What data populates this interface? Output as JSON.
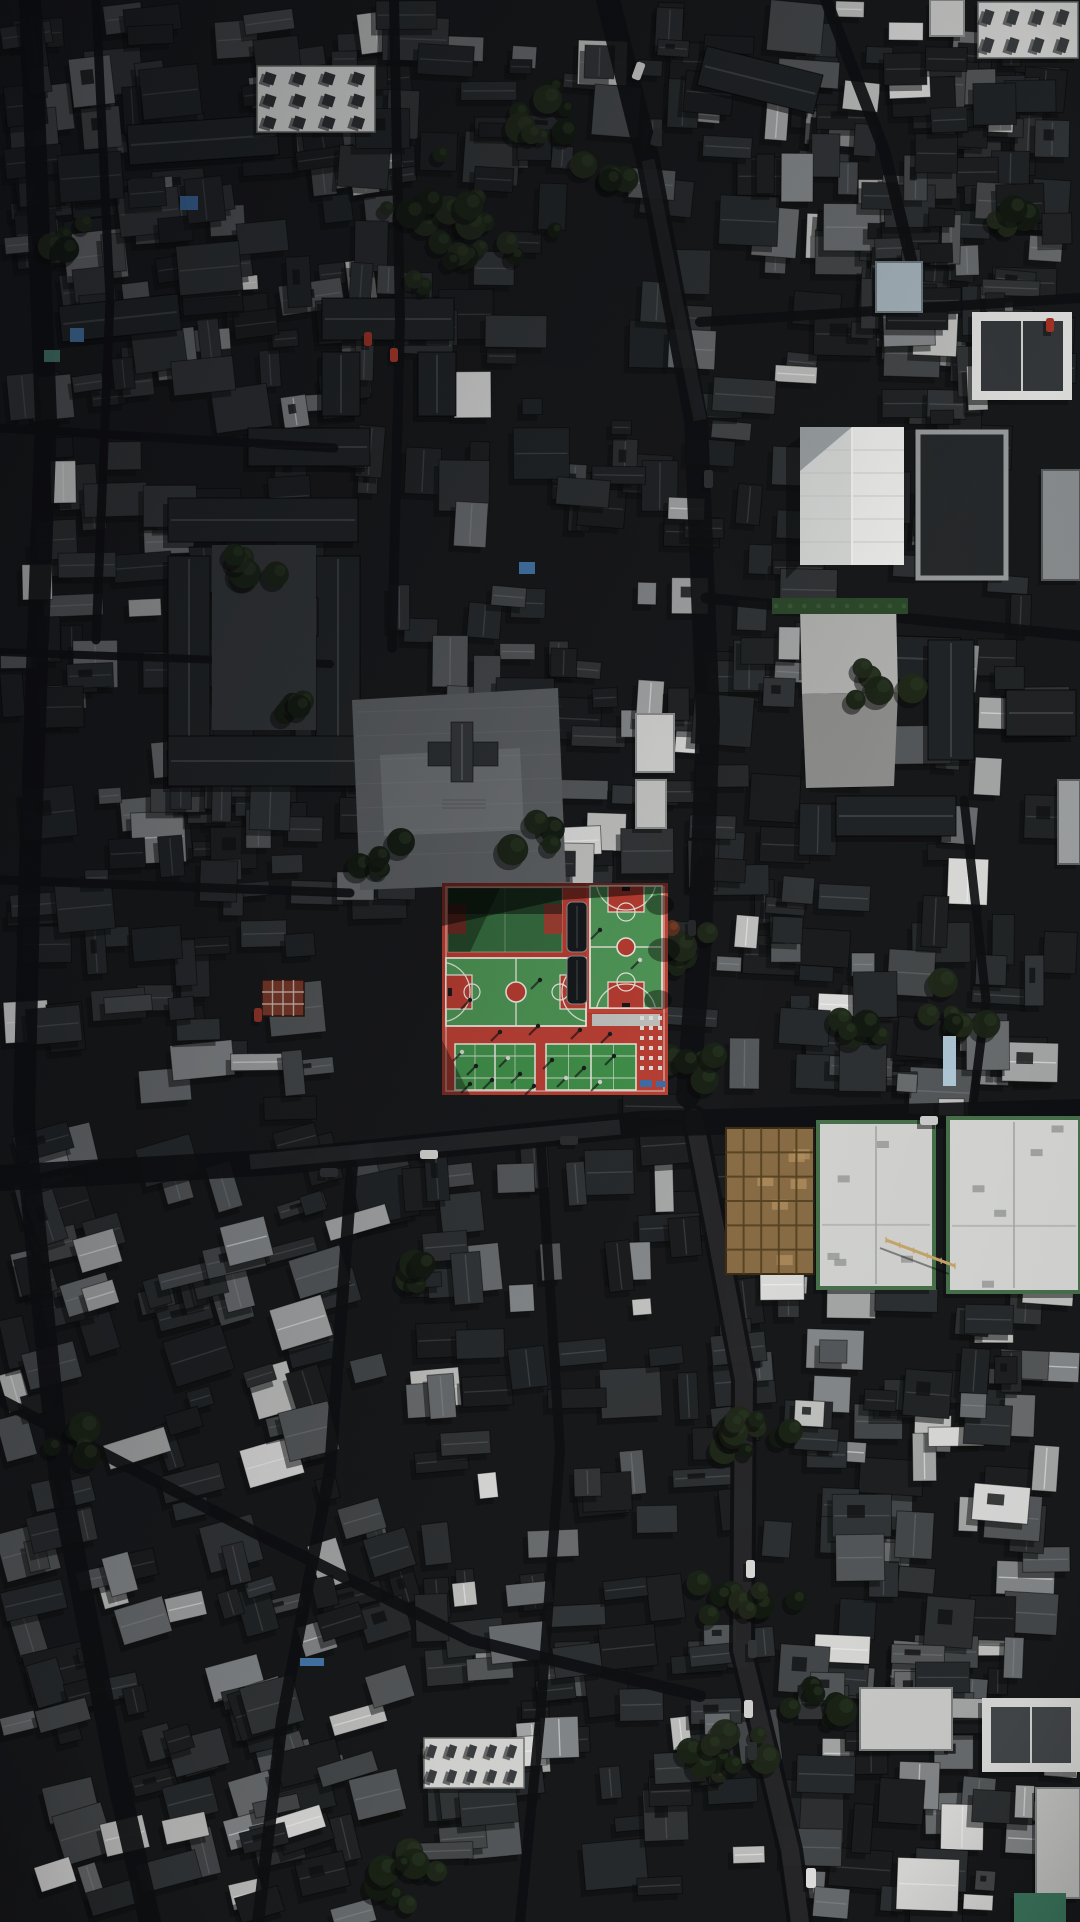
{
  "scene": {
    "type": "aerial-drone-photograph",
    "description": "Top-down aerial photo of a dense dark-roofed old city district; a bright red and green school sports complex (basketball and badminton courts) sits at the center, surrounded by charcoal tiled rooftops, narrow shadowed streets, tree clusters, a white gabled hall, large white flat roofs, and a tan construction site.",
    "canvas": {
      "width": 1080,
      "height": 1922
    },
    "seed": 1337,
    "palette": {
      "base": "#17181a",
      "street": "#0e0f11",
      "street_lit": "#3a3b3d",
      "roof_dark": [
        "#1d1f21",
        "#212426",
        "#272a2c",
        "#2d3032",
        "#323537",
        "#1a1c1e"
      ],
      "roof_mid": [
        "#45484a",
        "#55585a",
        "#6a6d6f"
      ],
      "roof_light": [
        "#86898b",
        "#a7a9a9",
        "#c3c4c2",
        "#dededd"
      ],
      "tree": [
        "#131a11",
        "#1a2316",
        "#20291a"
      ],
      "court_red": "#b93c30",
      "court_red_bright": "#c7463a",
      "court_green": "#4d9554",
      "court_green_shaded": "#356b3d",
      "court_line": "#efeee4",
      "construction_tan": "#8a6d46",
      "hedge_green": "#2d4a2b",
      "tarp_blue": "#3f6fa8"
    },
    "sun": {
      "from": "upper-right",
      "shadow_dx": -5,
      "shadow_dy": 6
    }
  },
  "districts": [
    {
      "x": 0,
      "y": 0,
      "w": 420,
      "h": 430,
      "n": 120,
      "light": 0.1,
      "mid": 0.18,
      "angle": -6
    },
    {
      "x": 330,
      "y": 0,
      "w": 350,
      "h": 700,
      "n": 70,
      "light": 0.06,
      "mid": 0.12,
      "angle": 2
    },
    {
      "x": 620,
      "y": 0,
      "w": 460,
      "h": 640,
      "n": 130,
      "light": 0.1,
      "mid": 0.16,
      "angle": 3
    },
    {
      "x": 860,
      "y": 0,
      "w": 220,
      "h": 430,
      "n": 60,
      "light": 0.12,
      "mid": 0.2,
      "angle": 0
    },
    {
      "x": 0,
      "y": 420,
      "w": 340,
      "h": 700,
      "n": 90,
      "light": 0.08,
      "mid": 0.15,
      "angle": -3
    },
    {
      "x": 150,
      "y": 700,
      "w": 300,
      "h": 220,
      "n": 40,
      "light": 0.06,
      "mid": 0.1,
      "angle": 0
    },
    {
      "x": 440,
      "y": 640,
      "w": 230,
      "h": 260,
      "n": 30,
      "light": 0.12,
      "mid": 0.2,
      "angle": 0
    },
    {
      "x": 620,
      "y": 620,
      "w": 460,
      "h": 500,
      "n": 110,
      "light": 0.1,
      "mid": 0.16,
      "angle": 2
    },
    {
      "x": 0,
      "y": 1120,
      "w": 420,
      "h": 810,
      "n": 150,
      "light": 0.16,
      "mid": 0.22,
      "angle": -15
    },
    {
      "x": 400,
      "y": 1120,
      "w": 380,
      "h": 800,
      "n": 110,
      "light": 0.12,
      "mid": 0.2,
      "angle": -4
    },
    {
      "x": 760,
      "y": 1260,
      "w": 320,
      "h": 670,
      "n": 120,
      "light": 0.3,
      "mid": 0.25,
      "angle": 2
    }
  ],
  "courtyard_roofs": [
    [
      168,
      498,
      190,
      44,
      0
    ],
    [
      168,
      556,
      42,
      226,
      0
    ],
    [
      316,
      556,
      44,
      226,
      0
    ],
    [
      168,
      736,
      234,
      50,
      0
    ],
    [
      226,
      598,
      92,
      38,
      0
    ],
    [
      322,
      298,
      132,
      42,
      0
    ],
    [
      322,
      352,
      38,
      64,
      0
    ],
    [
      418,
      352,
      38,
      64,
      0
    ],
    [
      248,
      428,
      122,
      38,
      0
    ],
    [
      128,
      120,
      150,
      40,
      -4
    ],
    [
      60,
      300,
      120,
      36,
      -6
    ],
    [
      840,
      636,
      120,
      44,
      2
    ],
    [
      928,
      640,
      46,
      120,
      0
    ],
    [
      1006,
      690,
      70,
      46,
      0
    ],
    [
      836,
      796,
      120,
      40,
      0
    ],
    [
      700,
      60,
      120,
      40,
      14
    ]
  ],
  "streets": [
    {
      "pts": [
        [
          30,
          0
        ],
        [
          46,
          420
        ],
        [
          30,
          860
        ],
        [
          24,
          1120
        ],
        [
          60,
          1480
        ],
        [
          120,
          1790
        ],
        [
          150,
          1922
        ]
      ],
      "w": 22
    },
    {
      "pts": [
        [
          96,
          0
        ],
        [
          110,
          300
        ],
        [
          96,
          640
        ]
      ],
      "w": 9
    },
    {
      "pts": [
        [
          394,
          0
        ],
        [
          400,
          320
        ],
        [
          392,
          648
        ]
      ],
      "w": 10
    },
    {
      "pts": [
        [
          608,
          0
        ],
        [
          648,
          160
        ],
        [
          696,
          420
        ],
        [
          708,
          720
        ],
        [
          700,
          940
        ],
        [
          688,
          1096
        ]
      ],
      "w": 24
    },
    {
      "pts": [
        [
          694,
          1118
        ],
        [
          744,
          1380
        ],
        [
          742,
          1650
        ],
        [
          790,
          1850
        ],
        [
          800,
          1922
        ]
      ],
      "w": 26,
      "lit": true
    },
    {
      "pts": [
        [
          0,
          1178
        ],
        [
          280,
          1162
        ],
        [
          640,
          1124
        ],
        [
          1080,
          1112
        ]
      ],
      "w": 26
    },
    {
      "pts": [
        [
          700,
          322
        ],
        [
          1080,
          298
        ]
      ],
      "w": 10
    },
    {
      "pts": [
        [
          706,
          598
        ],
        [
          1080,
          636
        ]
      ],
      "w": 11
    },
    {
      "pts": [
        [
          0,
          880
        ],
        [
          350,
          893
        ]
      ],
      "w": 9
    },
    {
      "pts": [
        [
          0,
          428
        ],
        [
          334,
          448
        ]
      ],
      "w": 9
    },
    {
      "pts": [
        [
          0,
          652
        ],
        [
          330,
          664
        ]
      ],
      "w": 8
    },
    {
      "pts": [
        [
          0,
          1400
        ],
        [
          250,
          1530
        ],
        [
          470,
          1640
        ],
        [
          700,
          1696
        ]
      ],
      "w": 12
    },
    {
      "pts": [
        [
          352,
          1165
        ],
        [
          330,
          1470
        ],
        [
          282,
          1720
        ],
        [
          258,
          1922
        ]
      ],
      "w": 12
    },
    {
      "pts": [
        [
          540,
          1130
        ],
        [
          560,
          1450
        ],
        [
          540,
          1720
        ],
        [
          520,
          1922
        ]
      ],
      "w": 10
    },
    {
      "pts": [
        [
          826,
          0
        ],
        [
          884,
          150
        ],
        [
          914,
          272
        ]
      ],
      "w": 12
    },
    {
      "pts": [
        [
          964,
          800
        ],
        [
          986,
          1000
        ],
        [
          972,
          1112
        ]
      ],
      "w": 9
    }
  ],
  "plazas": [
    {
      "name": "temple-plaza",
      "points": "352,700 558,688 566,882 360,890",
      "fill": "#5d6062"
    },
    {
      "name": "temple-plaza-light",
      "points": "380,755 520,748 524,830 384,836",
      "fill": "#6e7173"
    },
    {
      "name": "school-courtyard-ground",
      "points": "212,545 316,545 316,730 212,730",
      "fill": "#333638"
    },
    {
      "name": "east-lot-upper",
      "points": "800,607 896,602 898,692 802,694",
      "fill": "#b3b4b2"
    },
    {
      "name": "east-lot-lower",
      "points": "802,694 898,692 894,786 806,788",
      "fill": "#8e8f8d"
    }
  ],
  "pagoda": {
    "cx": 462,
    "cy": 750,
    "fill": "#34373a",
    "steps": {
      "x": 442,
      "y": 796,
      "w": 44,
      "h": 16,
      "fill": "#6e7173"
    }
  },
  "landmarks": [
    {
      "name": "solar-roof-courtyard",
      "type": "panelroof",
      "x": 257,
      "y": 66,
      "w": 118,
      "h": 66,
      "fill": "#e8e9e7",
      "panel": "#2f3234",
      "rows": 3,
      "cols": 4
    },
    {
      "name": "white-gable-hall",
      "type": "gable",
      "x": 800,
      "y": 427,
      "w": 104,
      "h": 138,
      "face1": "#dcdedc",
      "face2": "#f2f2f0",
      "shadow": "#9aa0a2",
      "seams": 5
    },
    {
      "name": "bordered-dark-building",
      "type": "flat",
      "x": 918,
      "y": 432,
      "w": 88,
      "h": 146,
      "fill": "#26292b",
      "stroke": "#9a9d9e",
      "sw": 5
    },
    {
      "name": "hedge-strip",
      "type": "hedge",
      "x": 772,
      "y": 598,
      "w": 136,
      "h": 16,
      "fill": "#2d4a2b"
    },
    {
      "name": "slate-blue-roof",
      "type": "flat",
      "x": 876,
      "y": 262,
      "w": 46,
      "h": 50,
      "fill": "#a9b6bf",
      "stroke": "#6d7a83",
      "sw": 2
    },
    {
      "name": "top-right-white-block",
      "type": "panelroof",
      "x": 978,
      "y": 2,
      "w": 100,
      "h": 56,
      "fill": "#d8d9d7",
      "panel": "#3a3d3f",
      "rows": 2,
      "cols": 4
    },
    {
      "name": "top-right-small-white",
      "type": "flat",
      "x": 930,
      "y": 0,
      "w": 34,
      "h": 36,
      "fill": "#cfd0ce",
      "stroke": "#8f9291",
      "sw": 2
    },
    {
      "name": "white-framed-gable",
      "type": "framedgable",
      "x": 972,
      "y": 312,
      "w": 100,
      "h": 88,
      "frame": "#e4e5e3",
      "inner": "#35383b"
    },
    {
      "name": "construction-site",
      "type": "construction",
      "x": 726,
      "y": 1128,
      "w": 88,
      "h": 146,
      "fill": "#8a6d46",
      "beam": "#54411f",
      "patch": "#b2905f"
    },
    {
      "name": "big-white-roof-west",
      "type": "bigwhite",
      "x": 818,
      "y": 1122,
      "w": 116,
      "h": 166,
      "fill": "#d6d7d4",
      "trim": "#47714b"
    },
    {
      "name": "big-white-roof-east",
      "type": "bigwhite",
      "x": 948,
      "y": 1118,
      "w": 132,
      "h": 174,
      "fill": "#dadbd8",
      "trim": "#47714b"
    },
    {
      "name": "right-edge-lit-facade",
      "type": "flat",
      "x": 1042,
      "y": 470,
      "w": 38,
      "h": 110,
      "fill": "#8b8e90",
      "stroke": "#55585a",
      "sw": 2
    },
    {
      "name": "right-edge-lit-facade-2",
      "type": "flat",
      "x": 1058,
      "y": 780,
      "w": 22,
      "h": 84,
      "fill": "#9fa2a3",
      "stroke": "#5f6264",
      "sw": 2
    },
    {
      "name": "lower-right-white-a",
      "type": "flat",
      "x": 860,
      "y": 1688,
      "w": 92,
      "h": 62,
      "fill": "#cfd0cd",
      "stroke": "#7e8182",
      "sw": 2
    },
    {
      "name": "lower-right-white-b",
      "type": "framedgable",
      "x": 982,
      "y": 1698,
      "w": 98,
      "h": 74,
      "frame": "#dddedc",
      "inner": "#44474a"
    },
    {
      "name": "lower-right-white-c",
      "type": "flat",
      "x": 1036,
      "y": 1788,
      "w": 44,
      "h": 110,
      "fill": "#c9cac8",
      "stroke": "#8a8d8c",
      "sw": 2
    },
    {
      "name": "teal-tarp",
      "type": "flat",
      "x": 1014,
      "y": 1893,
      "w": 52,
      "h": 29,
      "fill": "#3d7a60"
    },
    {
      "name": "red-lattice-roof",
      "type": "grid",
      "x": 262,
      "y": 980,
      "w": 42,
      "h": 36,
      "fill": "#7e3a2a",
      "line": "#d8d0c2"
    },
    {
      "name": "white-strip-building",
      "type": "panelroof",
      "x": 424,
      "y": 1738,
      "w": 100,
      "h": 50,
      "fill": "#d9dad8",
      "panel": "#3b3e40",
      "rows": 2,
      "cols": 5
    },
    {
      "name": "east-white-annex",
      "type": "flat",
      "x": 636,
      "y": 714,
      "w": 38,
      "h": 58,
      "fill": "#d7d8d6",
      "stroke": "#8e918f",
      "sw": 2
    },
    {
      "name": "east-white-annex-2",
      "type": "flat",
      "x": 636,
      "y": 780,
      "w": 30,
      "h": 48,
      "fill": "#c9cac8",
      "stroke": "#8e918f",
      "sw": 2
    }
  ],
  "sports_complex": {
    "base": {
      "x": 442,
      "y": 883,
      "w": 226,
      "h": 212
    },
    "left_upper_court": {
      "x": 448,
      "y": 888,
      "w": 114,
      "h": 64
    },
    "left_main_court": {
      "x": 446,
      "y": 958,
      "w": 140,
      "h": 68
    },
    "right_court": {
      "x": 590,
      "y": 886,
      "w": 72,
      "h": 122
    },
    "canopies": [
      [
        567,
        902,
        20,
        50
      ],
      [
        567,
        956,
        20,
        48
      ]
    ],
    "badminton_courts": [
      [
        455,
        1044,
        80,
        46
      ],
      [
        546,
        1044,
        90,
        46
      ]
    ],
    "equipment_area": {
      "x": 637,
      "y": 1012,
      "w": 30,
      "h": 64
    },
    "bench_strip": {
      "x": 592,
      "y": 1014,
      "w": 68,
      "h": 12,
      "fill": "#c4c5c1"
    },
    "tarp_items": [
      [
        640,
        1080,
        12,
        7
      ],
      [
        656,
        1081,
        10,
        6
      ]
    ],
    "people": [
      [
        462,
        1052
      ],
      [
        476,
        1066
      ],
      [
        492,
        1080
      ],
      [
        470,
        1084
      ],
      [
        508,
        1058
      ],
      [
        520,
        1074
      ],
      [
        534,
        1086
      ],
      [
        552,
        1060
      ],
      [
        566,
        1078
      ],
      [
        584,
        1068
      ],
      [
        600,
        1082
      ],
      [
        614,
        1056
      ],
      [
        500,
        1032
      ],
      [
        538,
        1026
      ],
      [
        580,
        1030
      ],
      [
        610,
        1034
      ],
      [
        470,
        1000
      ],
      [
        540,
        980
      ],
      [
        600,
        930
      ],
      [
        640,
        960
      ]
    ]
  },
  "tree_clusters": [
    [
      468,
      225,
      24,
      95
    ],
    [
      540,
      110,
      8,
      46
    ],
    [
      610,
      180,
      6,
      40
    ],
    [
      676,
      955,
      9,
      46
    ],
    [
      700,
      1060,
      5,
      36
    ],
    [
      735,
      1430,
      12,
      60
    ],
    [
      752,
      1590,
      10,
      56
    ],
    [
      726,
      1760,
      9,
      50
    ],
    [
      820,
      1690,
      6,
      40
    ],
    [
      420,
      1870,
      10,
      48
    ],
    [
      380,
      855,
      5,
      36
    ],
    [
      532,
      845,
      4,
      30
    ],
    [
      240,
      560,
      6,
      44
    ],
    [
      300,
      705,
      5,
      36
    ],
    [
      80,
      1450,
      5,
      40
    ],
    [
      430,
      1270,
      4,
      34
    ],
    [
      960,
      1010,
      8,
      44
    ],
    [
      880,
      690,
      5,
      40
    ],
    [
      1005,
      230,
      6,
      40
    ],
    [
      70,
      240,
      5,
      36
    ],
    [
      860,
      1030,
      5,
      36
    ]
  ],
  "autumn_tree": {
    "x": 672,
    "y": 928,
    "r": 8,
    "fill": "#5c2f1f"
  },
  "vehicles": [
    [
      806,
      1868,
      10,
      20,
      "#e8e8e6",
      0
    ],
    [
      744,
      1700,
      9,
      18,
      "#d8d8d6",
      0
    ],
    [
      748,
      1742,
      9,
      18,
      "#2c2e30",
      0
    ],
    [
      748,
      1640,
      9,
      18,
      "#333537",
      0
    ],
    [
      746,
      1560,
      9,
      18,
      "#dededc",
      0
    ],
    [
      634,
      62,
      9,
      18,
      "#d6d6d4",
      20
    ],
    [
      652,
      128,
      9,
      18,
      "#2a2c2e",
      15
    ],
    [
      704,
      470,
      9,
      18,
      "#303234",
      0
    ],
    [
      688,
      920,
      8,
      16,
      "#26282a",
      0
    ],
    [
      364,
      332,
      8,
      14,
      "#a33327",
      0
    ],
    [
      390,
      348,
      8,
      14,
      "#b23a2c",
      0
    ],
    [
      1046,
      318,
      8,
      14,
      "#aa3326",
      0
    ],
    [
      254,
      1008,
      8,
      14,
      "#99362a",
      0
    ],
    [
      320,
      1168,
      18,
      9,
      "#2e3032",
      0
    ],
    [
      420,
      1150,
      18,
      9,
      "#d9d9d7",
      0
    ],
    [
      560,
      1136,
      18,
      9,
      "#2b2d2f",
      0
    ],
    [
      920,
      1116,
      18,
      9,
      "#d0d1cf",
      0
    ]
  ],
  "accents": [
    [
      180,
      196,
      18,
      14,
      "#3f6fa8"
    ],
    [
      70,
      328,
      14,
      14,
      "#4a7fb5"
    ],
    [
      44,
      350,
      16,
      12,
      "#4e8578"
    ],
    [
      300,
      1658,
      24,
      8,
      "#4a7fb5"
    ],
    [
      943,
      1036,
      13,
      50,
      "#b8d3e2"
    ],
    [
      519,
      562,
      16,
      12,
      "#4a7fb5"
    ]
  ],
  "crane": {
    "x1": 886,
    "y1": 1240,
    "x2": 955,
    "y2": 1266,
    "color": "#c9a86b"
  }
}
